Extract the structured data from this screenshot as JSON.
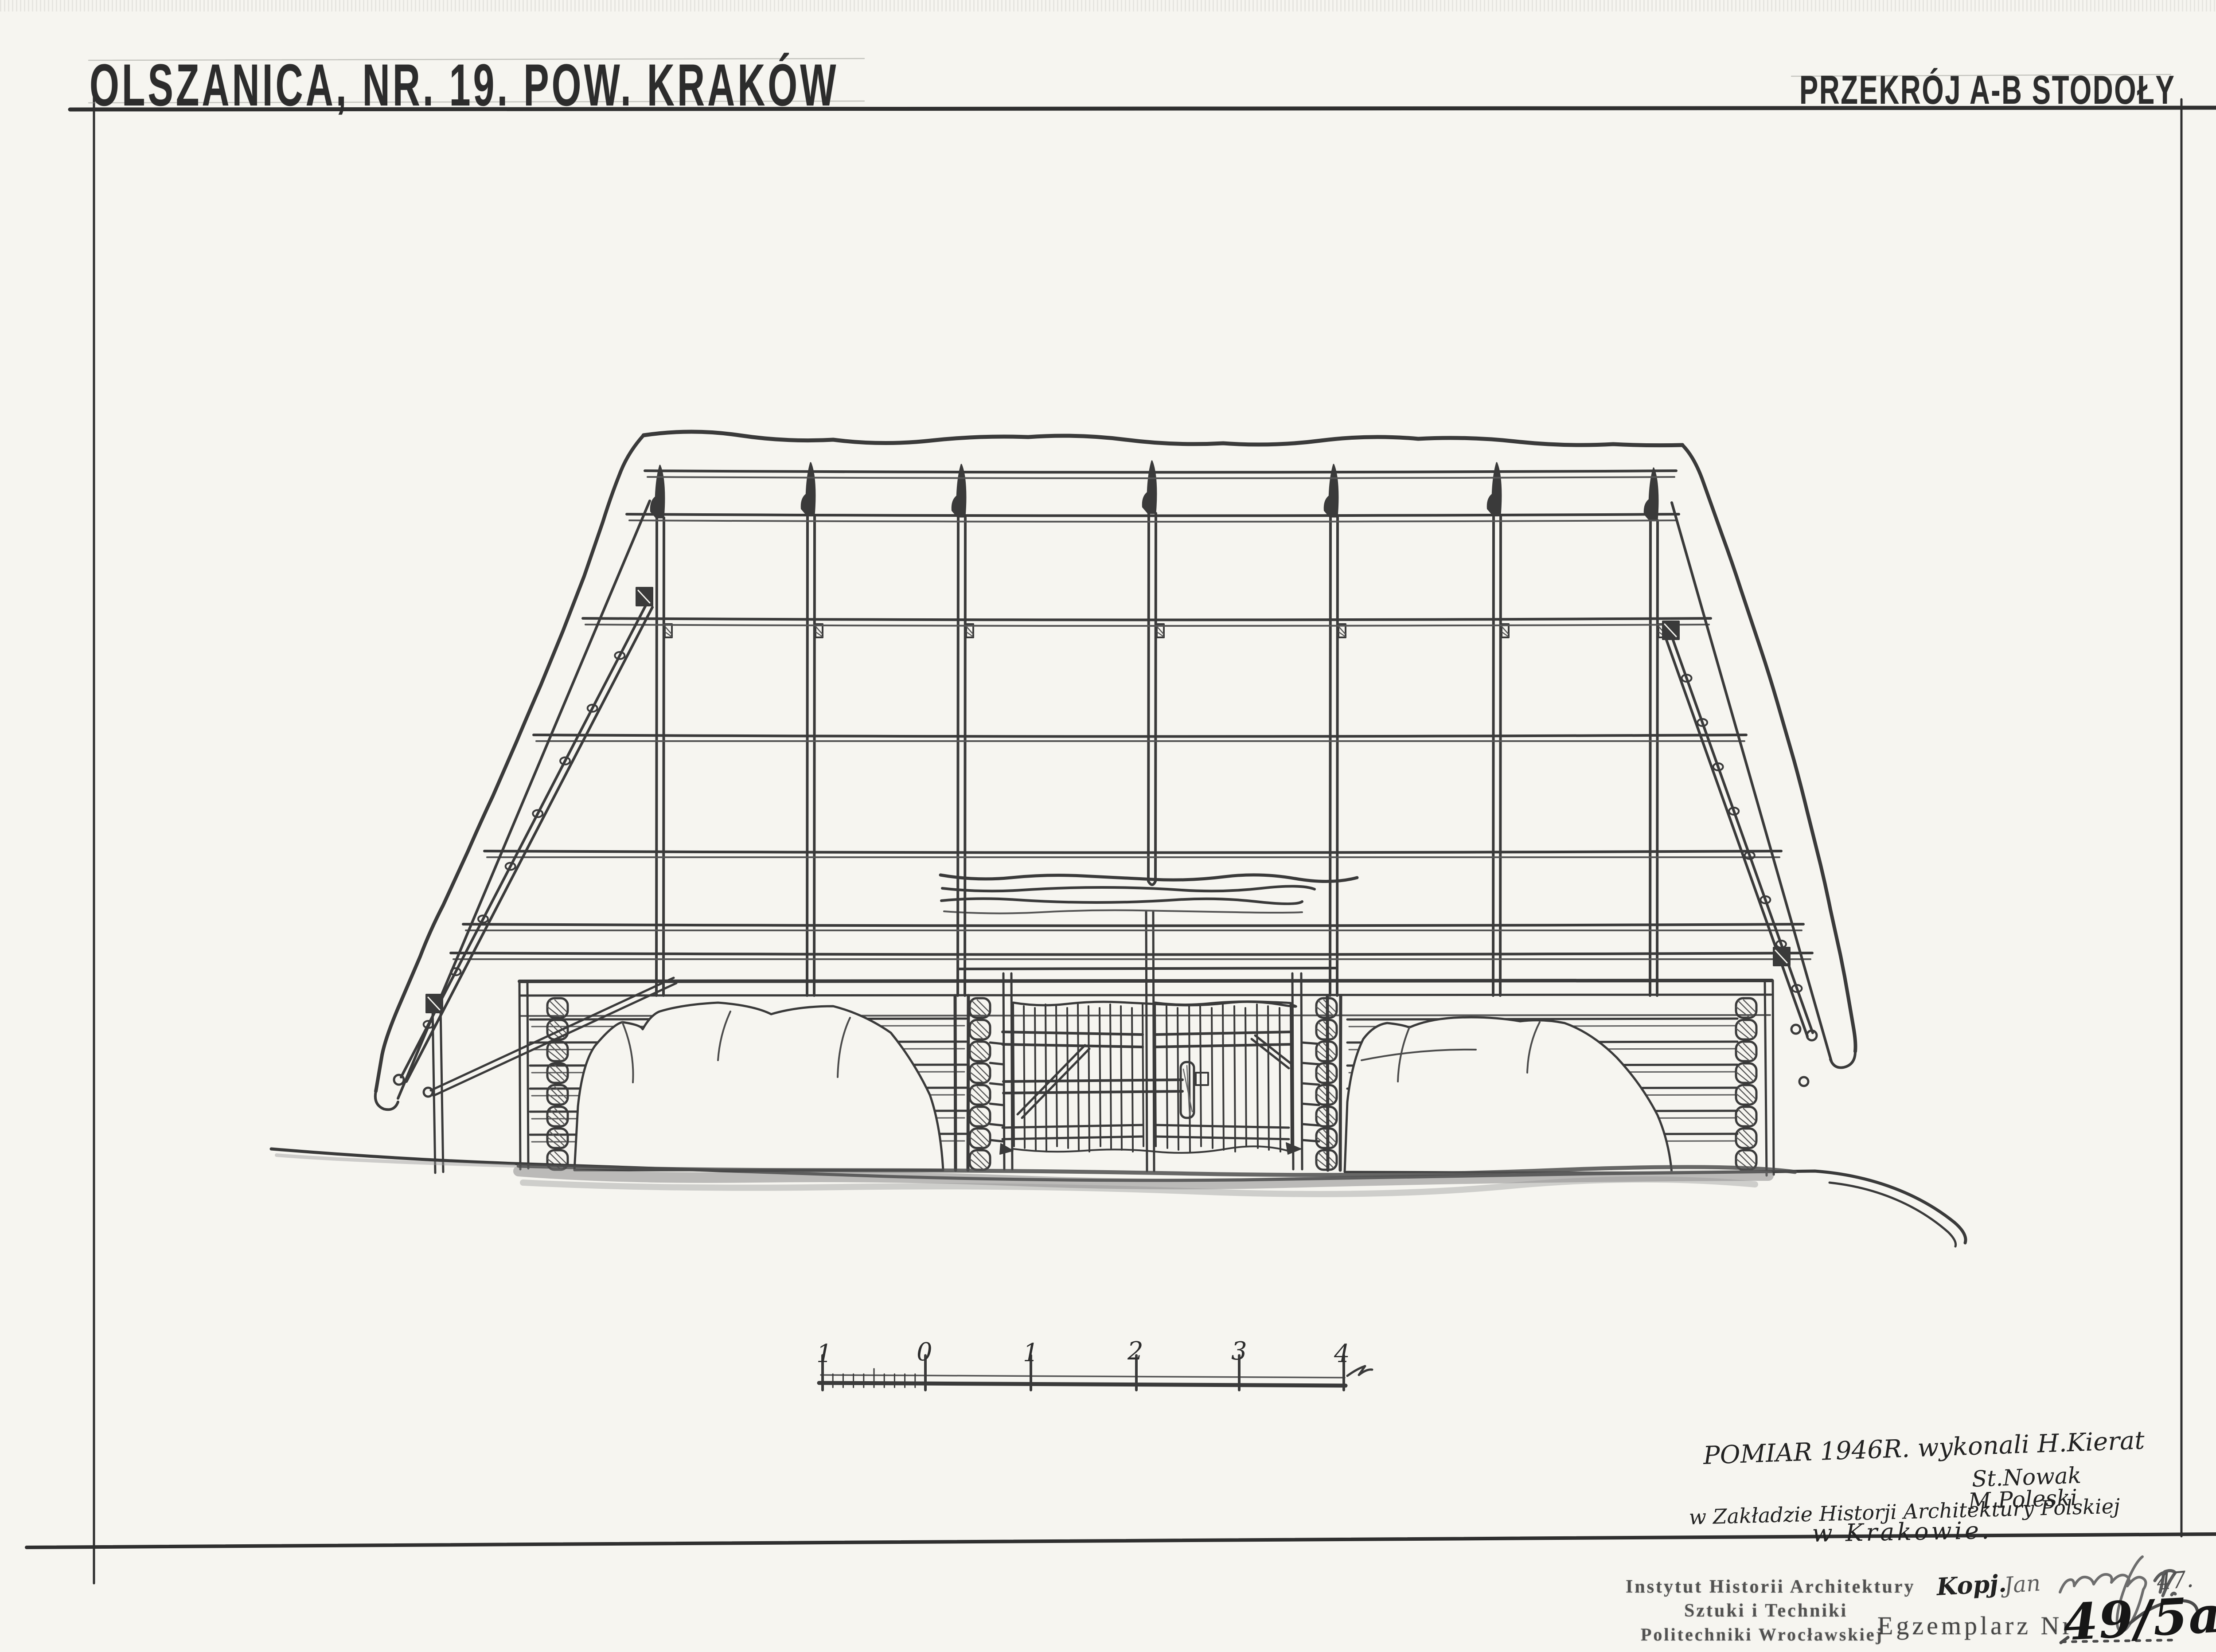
{
  "page": {
    "title_left": "OLSZANICA, NR. 19. POW. KRAKÓW",
    "title_right": "PRZEKRÓJ A-B STODOŁY"
  },
  "scale_bar": {
    "tick_labels": [
      "1",
      "0",
      "1",
      "2",
      "3",
      "4"
    ],
    "unit_label": "m"
  },
  "survey_note": {
    "line1": "POMIAR 1946R. wykonali H.Kierat",
    "line2": "St.Nowak",
    "line3": "M.Poleski",
    "line4": "w Zakładzie Historji Architektury Polskiej",
    "line5": "w Krakowie."
  },
  "copy_note": {
    "prefix": "Kopj.",
    "signature": "Jan",
    "year": "47."
  },
  "stamp": {
    "line1": "Instytut Historii Architektury",
    "line2": "Sztuki i Techniki",
    "line3": "Politechniki Wrocławskiej"
  },
  "exemplar": {
    "label": "Egzemplarz Nr",
    "number": "49/5a"
  },
  "colors": {
    "paper": "#f6f5f0",
    "pencil": "#3a3a3a",
    "pencil_light": "#8f8f8f",
    "stamp_ink": "#4a4a4a"
  }
}
